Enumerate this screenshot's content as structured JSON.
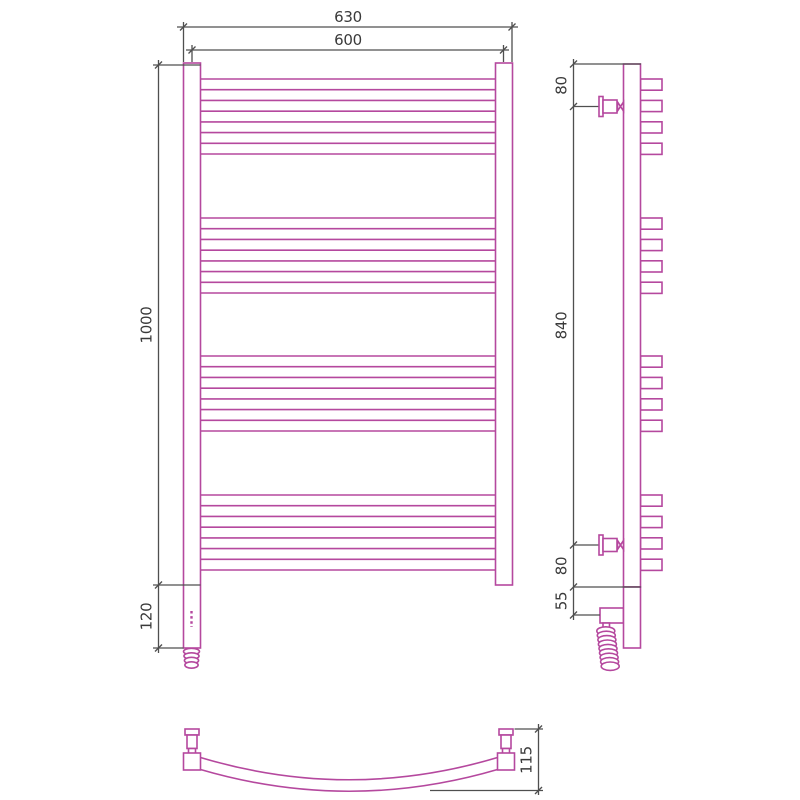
{
  "drawing": {
    "kind": "technical-dimension-drawing",
    "subject": "curved ladder towel radiator with electric heating element",
    "colors": {
      "outline": "#b5489e",
      "dimension_lines": "#4f4f4f",
      "text": "#3a3a3a",
      "background": "#ffffff"
    },
    "structure": {
      "rung_groups": 4,
      "rungs_per_group": 4,
      "coil_turns": 9,
      "thread_rings": 4
    },
    "dimensions": {
      "front": {
        "overall_width": "630",
        "axis_width": "600",
        "height": "1000",
        "bottom_extension": "120"
      },
      "side": {
        "top_bracket_offset": "80",
        "bracket_span": "840",
        "bottom_bracket_offset": "80",
        "lower_section": "55"
      },
      "bottom": {
        "curve_depth": "115"
      }
    }
  }
}
